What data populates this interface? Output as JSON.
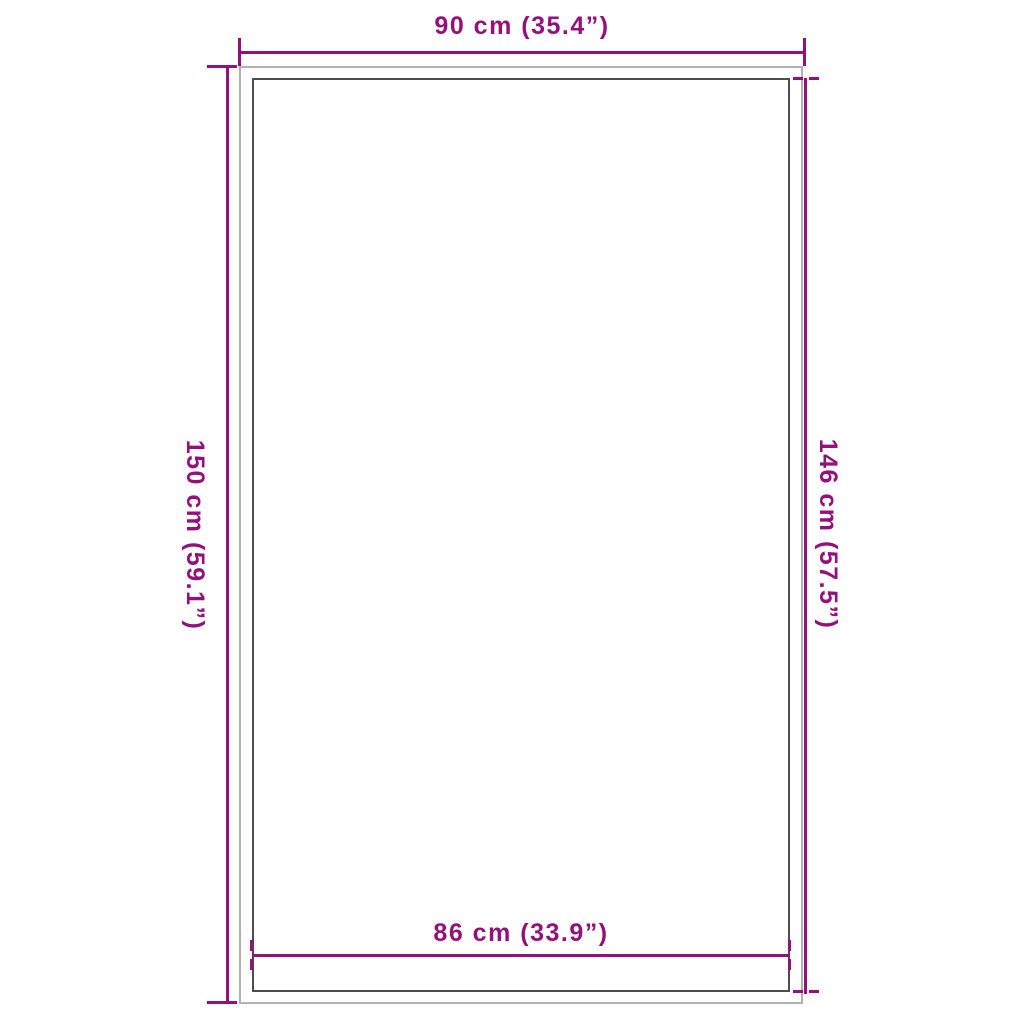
{
  "diagram": {
    "kind": "product-dimension-diagram",
    "dimensions": {
      "top": {
        "label": "90 cm (35.4”)"
      },
      "left": {
        "label": "150 cm (59.1”)"
      },
      "right": {
        "label": "146 cm (57.5”)"
      },
      "bottom": {
        "label": "86 cm (33.9”)"
      }
    },
    "colors": {
      "dimension_accent": "#93107D",
      "outer_edge": "#b2b2b2",
      "inner_edge": "#4d4d4d",
      "background": "#ffffff"
    }
  }
}
